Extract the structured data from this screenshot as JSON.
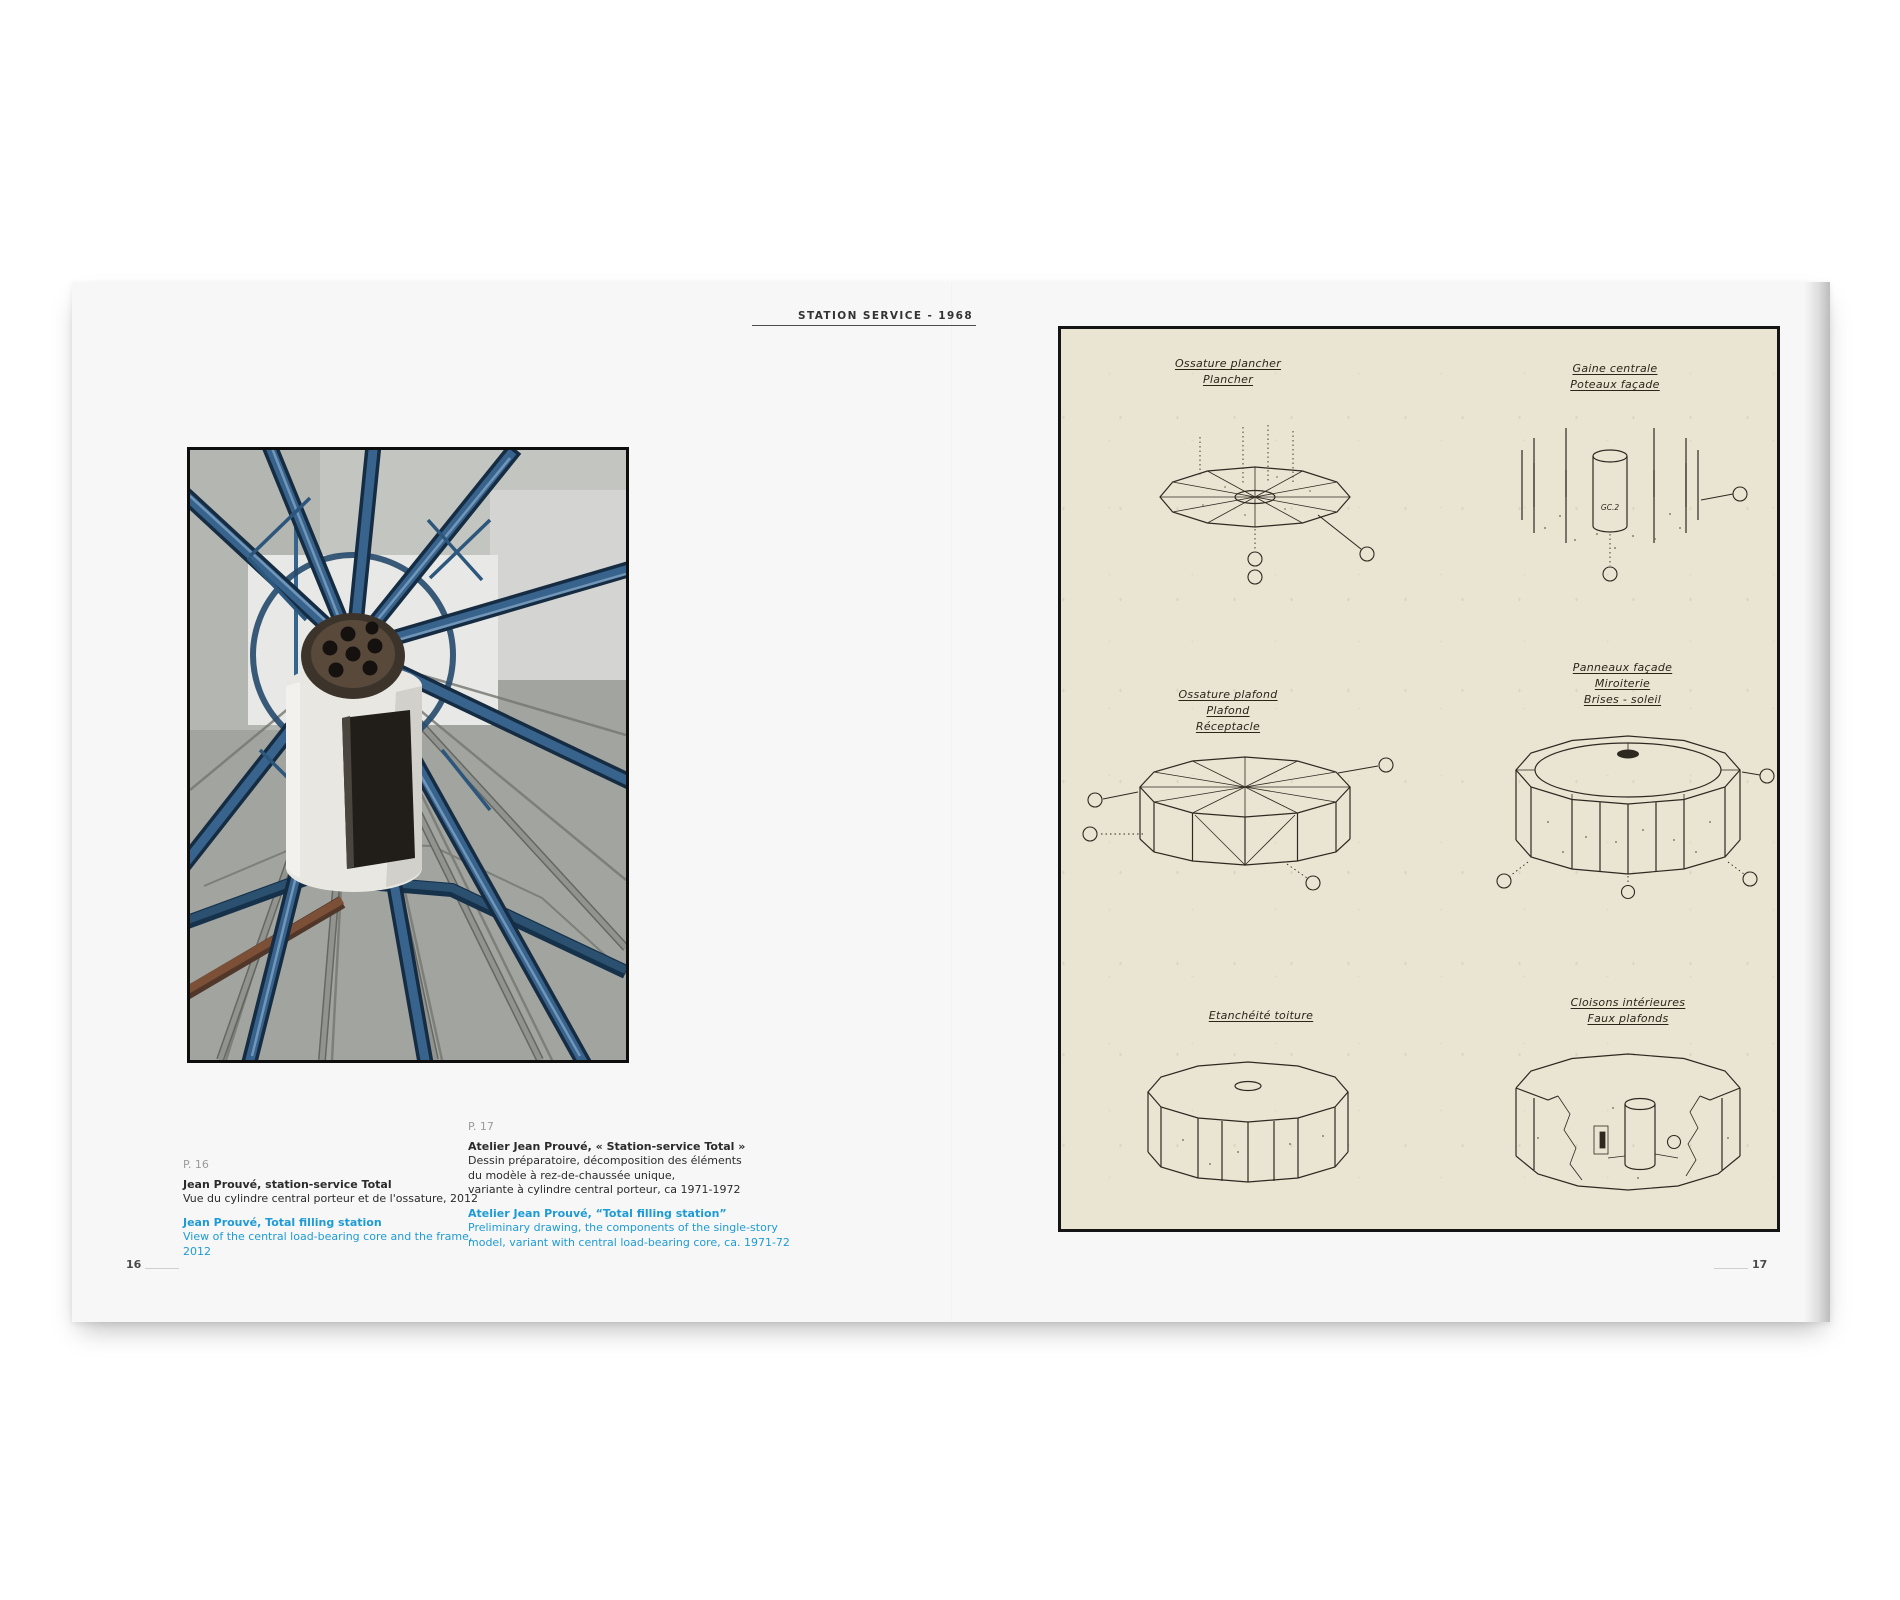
{
  "header": {
    "title": "STATION SERVICE - 1968"
  },
  "colors": {
    "accent_blue": "#1e9bd6",
    "panel_paper": "#eae4d3",
    "ink": "#2e2920",
    "spread_bg": "#f7f7f7"
  },
  "left_page": {
    "page_number": "16",
    "caption": {
      "page_ref": "P. 16",
      "fr_title": "Jean Prouvé, station-service Total",
      "fr_line": "Vue du cylindre central porteur et de l'ossature, 2012",
      "en_title": "Jean Prouvé, Total filling station",
      "en_line": "View of the central load-bearing core and the frame, 2012"
    }
  },
  "right_page": {
    "page_number": "17",
    "caption": {
      "page_ref": "P. 17",
      "fr_title": "Atelier Jean Prouvé, « Station-service Total »",
      "fr_lines": [
        "Dessin préparatoire, décomposition des éléments",
        "du modèle à rez-de-chaussée unique,",
        "variante à cylindre central porteur, ca 1971-1972"
      ],
      "en_title": "Atelier Jean Prouvé, “Total filling station”",
      "en_lines": [
        "Preliminary drawing, the components of the single-story",
        "model, variant with central load-bearing core, ca. 1971-72"
      ]
    },
    "panel": {
      "labels": {
        "d1": [
          "Ossature plancher",
          "Plancher"
        ],
        "d2": [
          "Gaine centrale",
          "Poteaux façade"
        ],
        "d3": [
          "Ossature plafond",
          "Plafond",
          "Réceptacle"
        ],
        "d4": [
          "Panneaux façade",
          "Miroiterie",
          "Brises - soleil"
        ],
        "d5": [
          "Etanchéité toiture"
        ],
        "d6": [
          "Cloisons intérieures",
          "Faux plafonds"
        ],
        "cylinder_note": "GC.2"
      }
    }
  }
}
